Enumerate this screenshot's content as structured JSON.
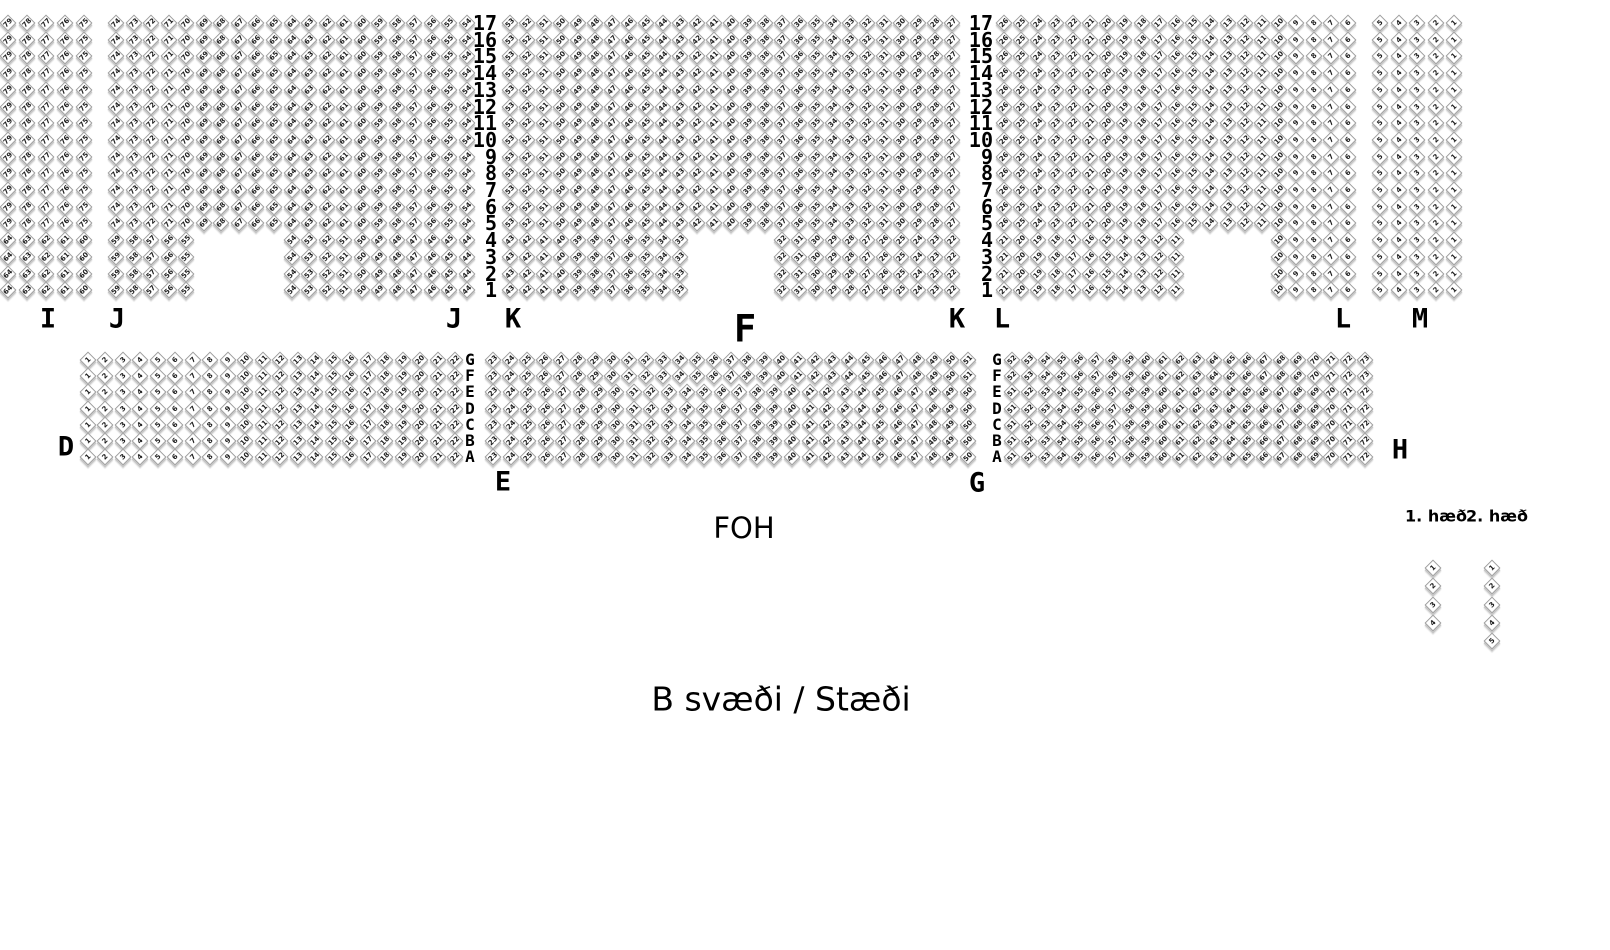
{
  "title": "B svæði / Stæði",
  "foh": "FOH",
  "top_block": {
    "y0": 23,
    "dy": 16.7,
    "full_row_count": 13,
    "row_labels": [
      "17",
      "16",
      "15",
      "14",
      "13",
      "12",
      "11",
      "10",
      "9",
      "8",
      "7",
      "6",
      "5",
      "4",
      "3",
      "2",
      "1"
    ],
    "row_label_cols_x": [
      497,
      993
    ],
    "label_y": 319,
    "sections": [
      {
        "name": "I",
        "x0": 8,
        "dx": 19,
        "cols": 5,
        "top_start": 79,
        "notch_groups": [
          {
            "col": 0,
            "count": 5,
            "start": 64
          }
        ]
      },
      {
        "name": "J",
        "x0": 116,
        "dx": 17.55,
        "cols": 21,
        "top_start": 74,
        "notch_groups": [
          {
            "col": 0,
            "count": 5,
            "start": 59
          },
          {
            "col": 10,
            "count": 11,
            "start": 54
          }
        ]
      },
      {
        "name": "K",
        "x0": 510,
        "dx": 17.0,
        "cols": 27,
        "top_start": 53,
        "notch_groups": [
          {
            "col": 0,
            "count": 11,
            "start": 43
          },
          {
            "col": 16,
            "count": 11,
            "start": 32
          }
        ]
      },
      {
        "name": "L",
        "x0": 1004,
        "dx": 17.2,
        "cols": 21,
        "top_start": 26,
        "notch_groups": [
          {
            "col": 0,
            "count": 11,
            "start": 21
          },
          {
            "col": 16,
            "count": 5,
            "start": 10
          }
        ]
      },
      {
        "name": "M",
        "x0": 1380,
        "dx": 18.5,
        "cols": 5,
        "top_start": 5,
        "notch_groups": [
          {
            "col": 0,
            "count": 5,
            "start": 5
          }
        ]
      }
    ],
    "section_labels": [
      {
        "text": "I",
        "x": 48
      },
      {
        "text": "J",
        "x": 117
      },
      {
        "text": "J",
        "x": 454
      },
      {
        "text": "K",
        "x": 513
      },
      {
        "text": "F",
        "x": 745,
        "y": 329,
        "big": true
      },
      {
        "text": "K",
        "x": 957
      },
      {
        "text": "L",
        "x": 1002
      },
      {
        "text": "L",
        "x": 1343
      },
      {
        "text": "M",
        "x": 1420
      }
    ]
  },
  "bottom_block": {
    "y0": 360,
    "dy": 16.2,
    "row_letters": [
      "G",
      "F",
      "E",
      "D",
      "C",
      "B",
      "A"
    ],
    "letter_cols_x": [
      470,
      997
    ],
    "sections": [
      {
        "name": "D",
        "x0": 88,
        "x1": 455,
        "rows": [
          {
            "rows": "all",
            "count": 22,
            "start": 1
          }
        ]
      },
      {
        "name": "E",
        "x0": 493,
        "x1": 968,
        "rows": [
          {
            "rows": [
              0,
              1
            ],
            "count": 29,
            "start": 23
          },
          {
            "rows": [
              2,
              3,
              4,
              5,
              6
            ],
            "count": 28,
            "start": 23
          }
        ]
      },
      {
        "name": "G",
        "x0": 1012,
        "x1": 1365,
        "rows": [
          {
            "rows": [
              0,
              1
            ],
            "count": 22,
            "start": 52
          },
          {
            "rows": [
              2,
              3,
              4,
              5,
              6
            ],
            "count": 22,
            "start": 51
          }
        ]
      }
    ],
    "section_labels": [
      {
        "text": "D",
        "x": 66,
        "y": 447
      },
      {
        "text": "E",
        "x": 503,
        "y": 482
      },
      {
        "text": "G",
        "x": 977,
        "y": 483
      },
      {
        "text": "H",
        "x": 1400,
        "y": 450
      }
    ]
  },
  "legend": {
    "label_y": 516,
    "floors": [
      {
        "label": "1. hæð",
        "label_x": 1436,
        "col_x": 1433,
        "y0": 568,
        "dy": 18.3,
        "seats": [
          "1",
          "2",
          "3",
          "4"
        ]
      },
      {
        "label": "2. hæð",
        "label_x": 1497,
        "col_x": 1492,
        "y0": 568,
        "dy": 18.3,
        "seats": [
          "1",
          "2",
          "3",
          "4",
          "5"
        ]
      }
    ]
  },
  "foh_pos": {
    "x": 744,
    "y": 528
  },
  "title_pos": {
    "x": 781,
    "y": 699
  }
}
